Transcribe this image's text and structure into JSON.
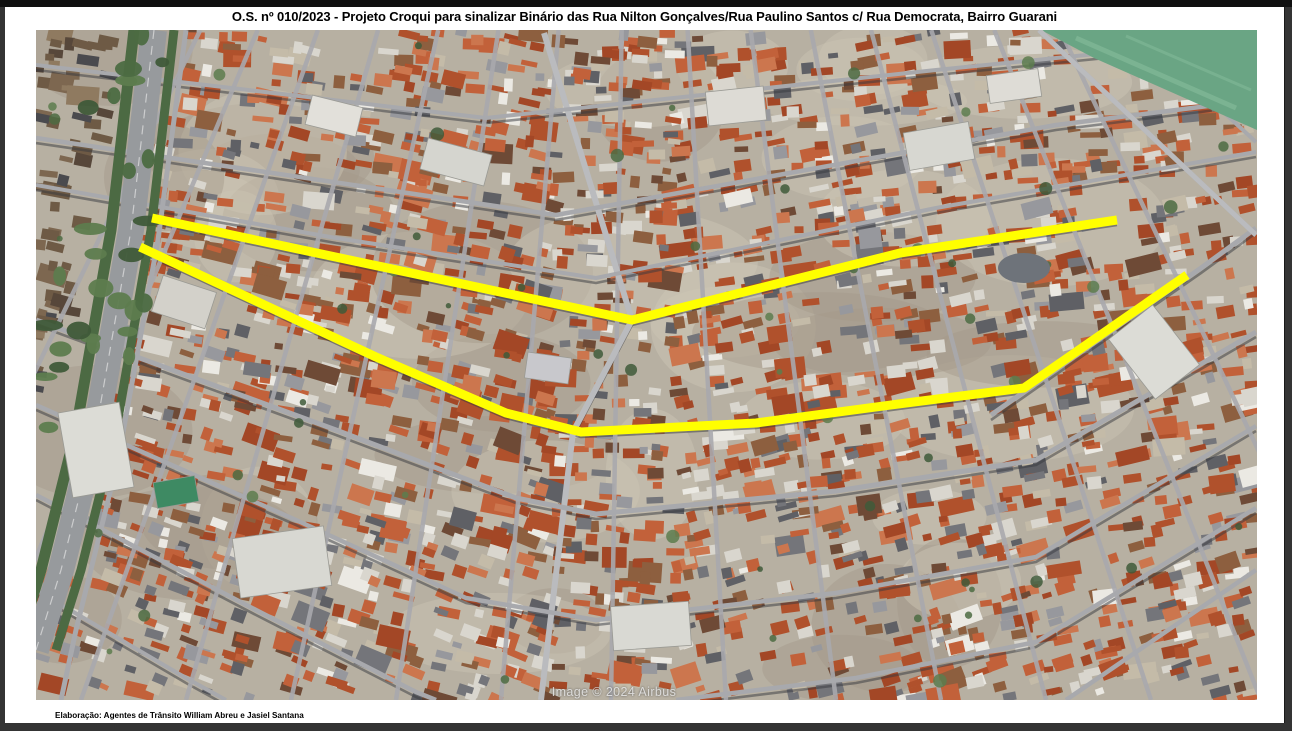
{
  "page": {
    "title": "O.S. nº 010/2023 - Projeto Croqui para sinalizar Binário das Rua Nilton Gonçalves/Rua Paulino Santos c/ Rua Democrata, Bairro Guarani",
    "credit": "Elaboração: Agentes de Trânsito William Abreu e Jasiel Santana",
    "frame_color": "#343434",
    "page_color": "#ffffff"
  },
  "map": {
    "watermark": "Image © 2024 Airbus",
    "width": 1221,
    "height": 670,
    "seed": 1337,
    "roof_count": 2600,
    "colors": {
      "ground": "#b7b0a2",
      "ground_light": "#cdc6b4",
      "ground_dark": "#a39a8a",
      "street": "#a8a9ad",
      "street_light": "#babbbe",
      "shadow": "#35373d",
      "tree_dark": "#3f5a39",
      "tree_mid": "#4c6b42",
      "tree_light": "#5d7c4e",
      "green_field": "#6aa584",
      "green_field_light": "#7fb796",
      "highway_road": "#979a9d",
      "highway_green": "#4c6a43",
      "court_green": "#3e8a63",
      "route_yellow": "#ffff00",
      "tank_gray": "#6e737a"
    },
    "roof_palette": [
      {
        "c": "#b0512c",
        "w": 3
      },
      {
        "c": "#c2613a",
        "w": 3
      },
      {
        "c": "#a34726",
        "w": 2
      },
      {
        "c": "#cc764e",
        "w": 2
      },
      {
        "c": "#8d5f3f",
        "w": 2
      },
      {
        "c": "#6e4a36",
        "w": 1
      },
      {
        "c": "#d9d6ce",
        "w": 2
      },
      {
        "c": "#ebe9e3",
        "w": 1
      },
      {
        "c": "#97989d",
        "w": 1
      },
      {
        "c": "#5f6065",
        "w": 1
      },
      {
        "c": "#74757a",
        "w": 1
      },
      {
        "c": "#c4bba8",
        "w": 1
      }
    ],
    "favela_palette": [
      {
        "c": "#6e5a45",
        "w": 3
      },
      {
        "c": "#7d6750",
        "w": 2
      },
      {
        "c": "#57473a",
        "w": 2
      },
      {
        "c": "#8f7a60",
        "w": 1
      },
      {
        "c": "#4a4a4e",
        "w": 1
      }
    ],
    "routes": {
      "width": 9,
      "top": [
        [
          116,
          188
        ],
        [
          596,
          290
        ],
        [
          864,
          223
        ],
        [
          1081,
          190
        ]
      ],
      "bottom": [
        [
          104,
          217
        ],
        [
          340,
          327
        ],
        [
          470,
          383
        ],
        [
          545,
          402
        ],
        [
          720,
          393
        ],
        [
          870,
          373
        ],
        [
          988,
          358
        ],
        [
          1151,
          245
        ]
      ]
    },
    "streets": {
      "horizontal": [
        {
          "pts": [
            [
              0,
              35
            ],
            [
              450,
              88
            ],
            [
              900,
              40
            ],
            [
              1220,
              8
            ]
          ],
          "w": 4
        },
        {
          "pts": [
            [
              0,
              108
            ],
            [
              520,
              185
            ],
            [
              1020,
              95
            ],
            [
              1220,
              70
            ]
          ],
          "w": 4.5
        },
        {
          "pts": [
            [
              0,
              155
            ],
            [
              300,
              208
            ],
            [
              560,
              248
            ],
            [
              900,
              178
            ],
            [
              1220,
              122
            ]
          ],
          "w": 4
        },
        {
          "pts": [
            [
              116,
              188
            ],
            [
              596,
              290
            ],
            [
              864,
              223
            ],
            [
              1081,
              190
            ]
          ],
          "w": 7
        },
        {
          "pts": [
            [
              104,
              217
            ],
            [
              340,
              327
            ],
            [
              470,
              383
            ],
            [
              545,
              402
            ],
            [
              720,
              393
            ],
            [
              870,
              373
            ],
            [
              988,
              358
            ],
            [
              1151,
              245
            ]
          ],
          "w": 7
        },
        {
          "pts": [
            [
              0,
              290
            ],
            [
              300,
              400
            ],
            [
              480,
              468
            ],
            [
              560,
              484
            ],
            [
              800,
              461
            ],
            [
              1000,
              430
            ],
            [
              1220,
              302
            ]
          ],
          "w": 5
        },
        {
          "pts": [
            [
              0,
              375
            ],
            [
              260,
              490
            ],
            [
              430,
              568
            ],
            [
              560,
              590
            ],
            [
              800,
              563
            ],
            [
              1000,
              527
            ],
            [
              1220,
              396
            ]
          ],
          "w": 4.5
        },
        {
          "pts": [
            [
              0,
              465
            ],
            [
              220,
              580
            ],
            [
              380,
              662
            ],
            [
              400,
              670
            ]
          ],
          "w": 4.5
        },
        {
          "pts": [
            [
              640,
              670
            ],
            [
              820,
              648
            ],
            [
              1000,
              612
            ],
            [
              1220,
              478
            ]
          ],
          "w": 4.5
        },
        {
          "pts": [
            [
              0,
              560
            ],
            [
              150,
              648
            ],
            [
              190,
              670
            ]
          ],
          "w": 4
        }
      ],
      "diagonals": [
        {
          "pts": [
            [
              1003,
              0
            ],
            [
              1220,
              205
            ]
          ],
          "w": 5
        },
        {
          "pts": [
            [
              1098,
              0
            ],
            [
              1220,
              112
            ]
          ],
          "w": 4
        },
        {
          "pts": [
            [
              955,
              385
            ],
            [
              1165,
              238
            ],
            [
              1220,
              198
            ]
          ],
          "w": 5
        },
        {
          "pts": [
            [
              1030,
              670
            ],
            [
              1220,
              540
            ]
          ],
          "w": 4.5
        }
      ],
      "spine": {
        "pts": [
          [
            508,
            3
          ],
          [
            596,
            290
          ],
          [
            537,
            402
          ],
          [
            505,
            670
          ]
        ],
        "w": 6
      },
      "fan": {
        "vp": [
          600,
          -900
        ],
        "anchors": [
          -160,
          -60,
          45,
          150,
          255,
          360,
          465,
          575,
          690,
          800,
          905,
          1010,
          1115,
          1225,
          1340
        ],
        "w": 4.5
      }
    },
    "highway": {
      "path": [
        [
          118,
          0
        ],
        [
          95,
          200
        ],
        [
          60,
          400
        ],
        [
          25,
          540
        ],
        [
          0,
          620
        ]
      ],
      "road_w": 26,
      "green_w": 11,
      "offset": 20,
      "frontage": {
        "pts": [
          [
            150,
            0
          ],
          [
            122,
            210
          ],
          [
            82,
            430
          ],
          [
            40,
            600
          ],
          [
            25,
            670
          ]
        ],
        "w": 5
      }
    },
    "green_field": [
      [
        1005,
        0
      ],
      [
        1221,
        0
      ],
      [
        1221,
        100
      ],
      [
        1058,
        28
      ]
    ],
    "specials": [
      [
        60,
        420,
        62,
        86,
        -10,
        "#dcdcd6"
      ],
      [
        246,
        532,
        92,
        60,
        -8,
        "#d8d8d2"
      ],
      [
        298,
        86,
        52,
        30,
        14,
        "#e2e0da"
      ],
      [
        420,
        132,
        66,
        32,
        15,
        "#d5d5cf"
      ],
      [
        700,
        76,
        58,
        34,
        -6,
        "#dddbd5"
      ],
      [
        903,
        116,
        66,
        38,
        -10,
        "#d7d7d1"
      ],
      [
        1118,
        322,
        56,
        76,
        -38,
        "#dcdcd6"
      ],
      [
        148,
        272,
        56,
        38,
        18,
        "#d3d1ca"
      ],
      [
        615,
        596,
        78,
        44,
        -4,
        "#d9d9d3"
      ],
      [
        978,
        56,
        52,
        28,
        -8,
        "#dedcd6"
      ],
      [
        140,
        462,
        42,
        26,
        -10,
        "#3e8a63"
      ],
      [
        512,
        338,
        44,
        26,
        8,
        "#c8c8cc"
      ]
    ],
    "tank": {
      "x": 988,
      "y": 238,
      "rx": 26,
      "ry": 15
    }
  }
}
